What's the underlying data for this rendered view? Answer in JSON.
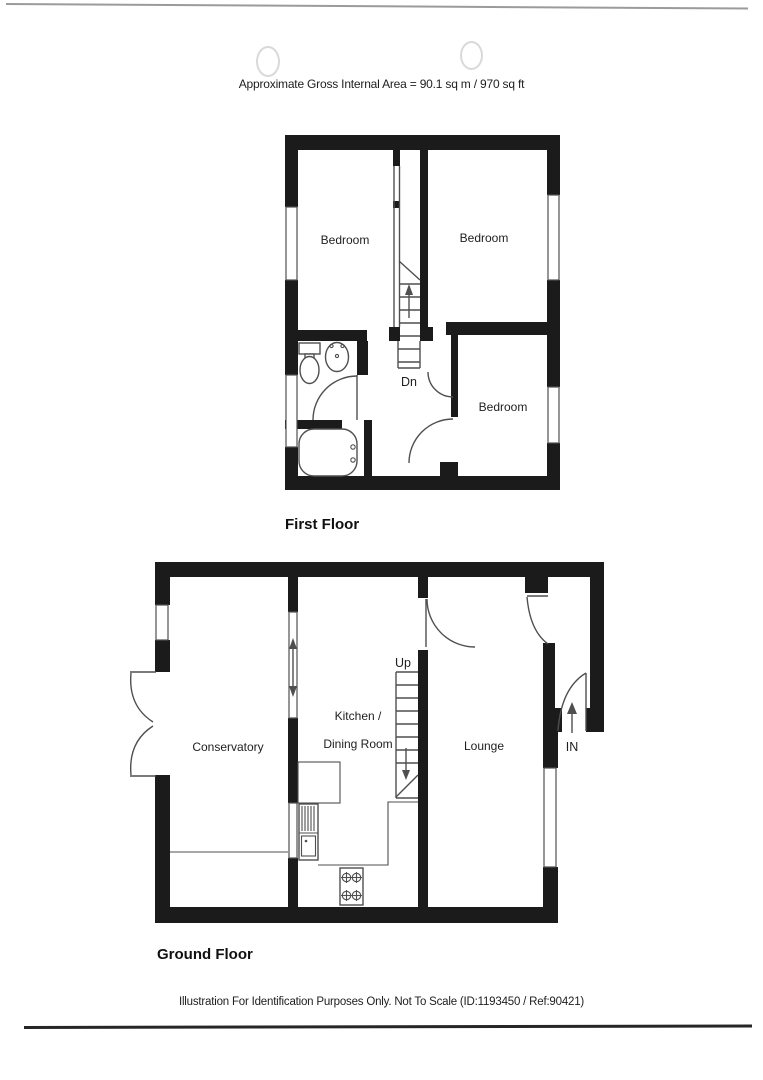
{
  "colors": {
    "wall": "#1b1b1b",
    "line": "#4f4f4f",
    "text": "#1e1e1e",
    "scanline": "#9b9b9b"
  },
  "header": {
    "area_note": "Approximate Gross Internal Area = 90.1 sq m / 970 sq ft"
  },
  "first_floor": {
    "label": "First Floor",
    "bedroom_left": "Bedroom",
    "bedroom_right": "Bedroom",
    "bedroom_small": "Bedroom",
    "stairs_down": "Dn"
  },
  "ground_floor": {
    "label": "Ground Floor",
    "conservatory": "Conservatory",
    "kitchen_line1": "Kitchen /",
    "kitchen_line2": "Dining Room",
    "lounge": "Lounge",
    "stairs_up": "Up",
    "entrance": "IN"
  },
  "footer": {
    "disclaimer": "Illustration For Identification Purposes Only. Not To Scale (ID:1193450 / Ref:90421)"
  }
}
